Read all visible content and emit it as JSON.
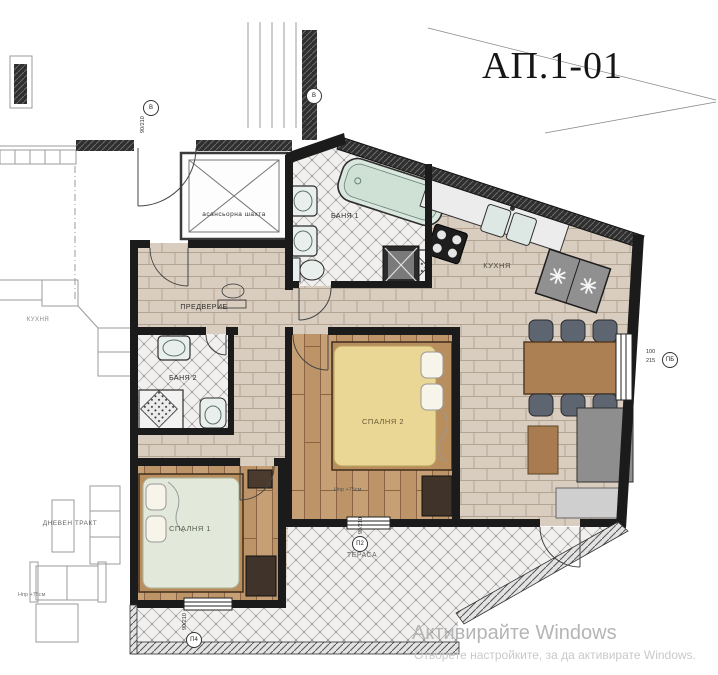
{
  "title": "АП.1-01",
  "rooms": {
    "elevator": "асансьорна шахта",
    "hall": "ПРЕДВЕРИЕ",
    "bath1": "БАНЯ 1",
    "bath2": "БАНЯ 2",
    "kitchen": "КУХНЯ",
    "bedroom1": "СПАЛНЯ 1",
    "bedroom2": "СПАЛНЯ 2",
    "terrace": "ТЕРАСА"
  },
  "neighbor": {
    "kitchen": "КУХНЯ",
    "living": "ДНЕВЕН ТРАКТ"
  },
  "notes": {
    "parapet1": "Нпр +75см",
    "parapet2": "Нпр +75см"
  },
  "tags": {
    "entry_door": {
      "letter": "В",
      "size": "90/210"
    },
    "stair_door": {
      "letter": "В",
      "size": "90/210"
    },
    "terrace_door": {
      "letter": "П2",
      "size": "90/210"
    },
    "bedroom1_window": {
      "letter": "П4",
      "size": "90/210"
    },
    "right_window": {
      "letter": "ПБ",
      "width": "100",
      "height": "215"
    }
  },
  "watermark": {
    "line1": "Активирайте Windows",
    "line2": "Отворете настройките, за да активирате Windows."
  },
  "colors": {
    "wall": "#1b1b1b",
    "brick_floor": "#d9cdbf",
    "plank_floor": "#c79f74",
    "tile_floor": "#f1f0ee",
    "bathtub": "#d9e7de",
    "bed1_cover": "#e3e9da",
    "bed2_cover": "#ead695",
    "table": "#ad8054",
    "chair": "#5d6570",
    "fridge": "#909090",
    "watermark_text": "#b5b5b5"
  }
}
